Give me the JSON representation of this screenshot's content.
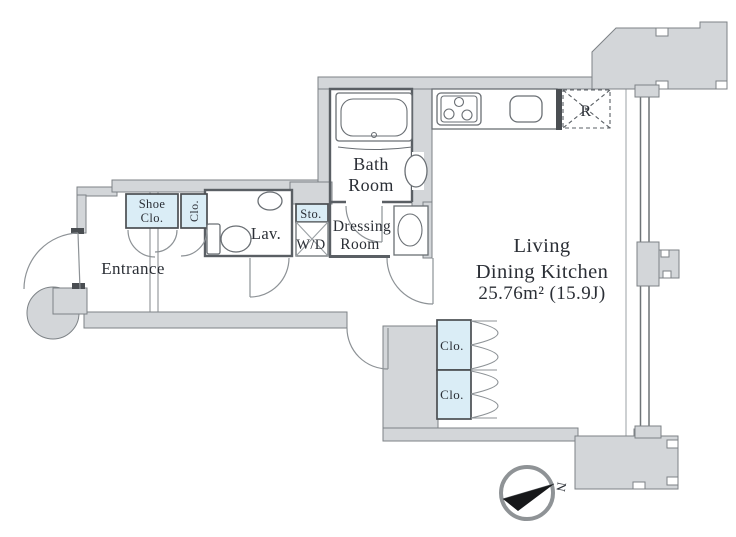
{
  "plan": {
    "rooms": {
      "entrance": {
        "label": "Entrance"
      },
      "shoe_closet": {
        "line1": "Shoe",
        "line2": "Clo."
      },
      "entry_closet": {
        "label": "Clo."
      },
      "lavatory": {
        "label": "Lav."
      },
      "storage": {
        "label": "Sto."
      },
      "washer_dryer": {
        "label": "W/D"
      },
      "bathroom": {
        "line1": "Bath",
        "line2": "Room"
      },
      "dressing_room": {
        "line1": "Dressing",
        "line2": "Room"
      },
      "living_dining_kitchen": {
        "line1": "Living",
        "line2": "Dining Kitchen",
        "area": "25.76m² (15.9J)"
      },
      "closet_upper": {
        "label": "Clo."
      },
      "closet_lower": {
        "label": "Clo."
      },
      "refrigerator_space": {
        "label": "R"
      }
    },
    "compass": {
      "north_label": "N"
    },
    "colors": {
      "wall_fill": "#d3d6d9",
      "wall_stroke": "#7d8286",
      "partition_stroke": "#5a5f64",
      "closet_fill": "#daedf6",
      "label_color": "#2b2f36",
      "accent_dark": "#4a4e52"
    }
  }
}
